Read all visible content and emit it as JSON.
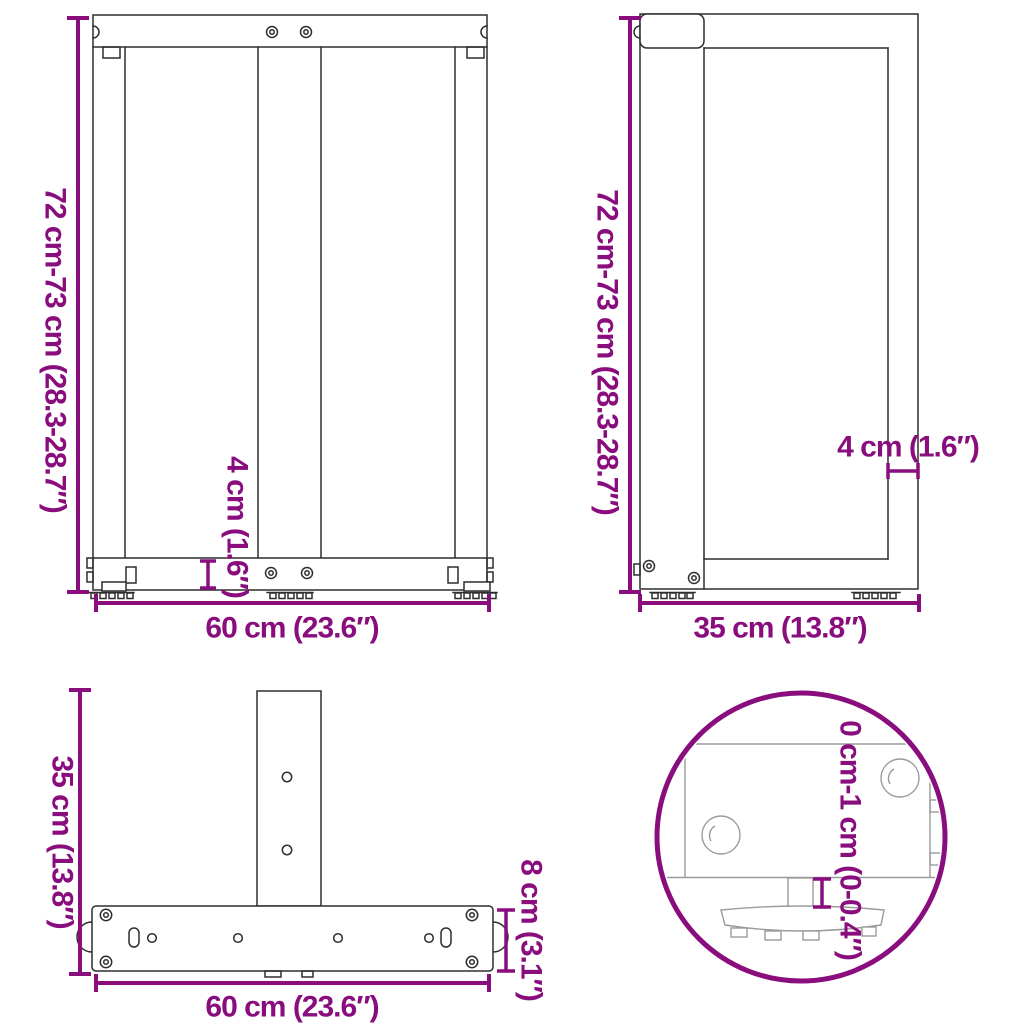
{
  "page": {
    "title": "T-shaped table legs dimension diagram",
    "background": "#FFFFFF"
  },
  "colors": {
    "dimension_accent": "#8A0D7E",
    "drawing_line": "#2E2E2E",
    "detail_line": "#9B9B9B"
  },
  "views": {
    "front": {
      "height_label": "72 cm-73 cm (28.3-28.7″)",
      "width_label": "60 cm (23.6″)",
      "bar_thickness_label": "4 cm (1.6″)"
    },
    "side": {
      "height_label": "72 cm-73 cm (28.3-28.7″)",
      "depth_label": "35 cm (13.8″)",
      "tube_thickness_label": "4 cm (1.6″)"
    },
    "top": {
      "depth_label": "35 cm (13.8″)",
      "width_label": "60 cm (23.6″)",
      "bar_width_label": "8 cm (3.1″)"
    },
    "detail": {
      "adjustment_range_label": "0 cm-1 cm (0-0.4″)"
    }
  }
}
